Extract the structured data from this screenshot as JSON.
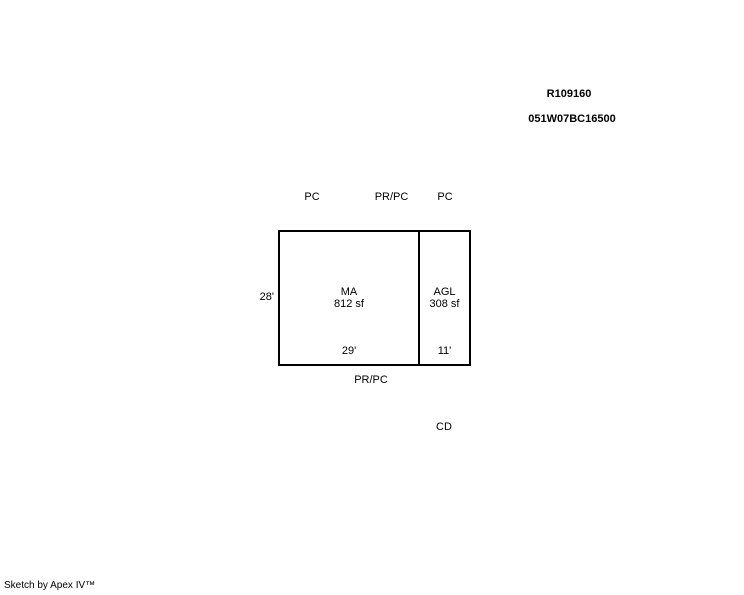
{
  "colors": {
    "background": "#ffffff",
    "ink": "#000000",
    "line": "#000000"
  },
  "header": {
    "record_id": "R109160",
    "parcel_id": "051W07BC16500"
  },
  "sketch": {
    "top_labels": {
      "left": "PC",
      "center": "PR/PC",
      "right": "PC"
    },
    "left_dimension": "28'",
    "sections": [
      {
        "code": "MA",
        "area": "812 sf",
        "width_dimension": "29'"
      },
      {
        "code": "AGL",
        "area": "308 sf",
        "width_dimension": "11'"
      }
    ],
    "bottom_label": "PR/PC",
    "detached_label": "CD"
  },
  "footer": {
    "credit": "Sketch by Apex IV™"
  }
}
